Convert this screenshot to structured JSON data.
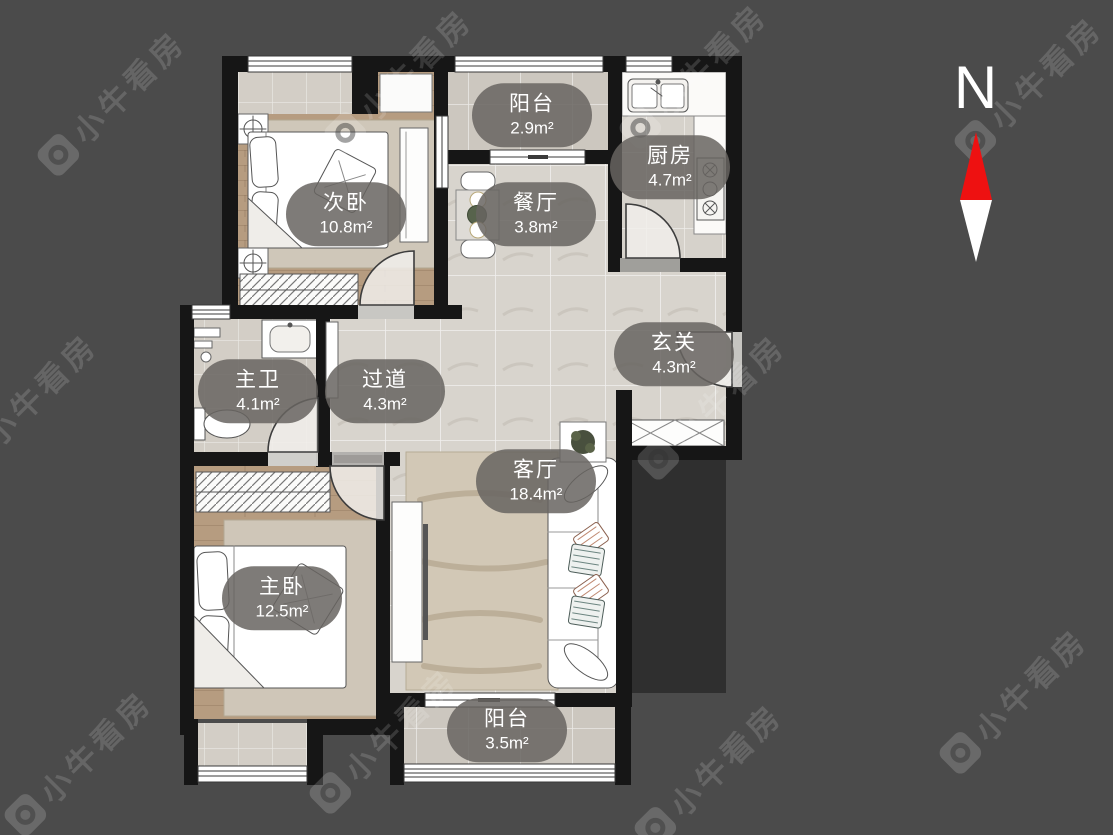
{
  "background": {
    "color": "#4b4b4b"
  },
  "watermark": {
    "text": "小牛看房"
  },
  "compass": {
    "label": "N",
    "north_color": "#ee1111",
    "south_color": "#ffffff"
  },
  "rooms": [
    {
      "name": "次卧",
      "area": "10.8m²"
    },
    {
      "name": "阳台",
      "area": "2.9m²"
    },
    {
      "name": "餐厅",
      "area": "3.8m²"
    },
    {
      "name": "厨房",
      "area": "4.7m²"
    },
    {
      "name": "玄关",
      "area": "4.3m²"
    },
    {
      "name": "主卫",
      "area": "4.1m²"
    },
    {
      "name": "过道",
      "area": "4.3m²"
    },
    {
      "name": "客厅",
      "area": "18.4m²"
    },
    {
      "name": "主卧",
      "area": "12.5m²"
    },
    {
      "name": "阳台",
      "area": "3.5m²"
    }
  ],
  "colors": {
    "wall": "#161616",
    "label_background": "rgba(103,100,96,0.85)",
    "wood_floor": "#b69c80",
    "tile_floor": "#d8d4cd",
    "rug": "#d2c8b6",
    "outside_shaft": "#2f2f2f"
  }
}
